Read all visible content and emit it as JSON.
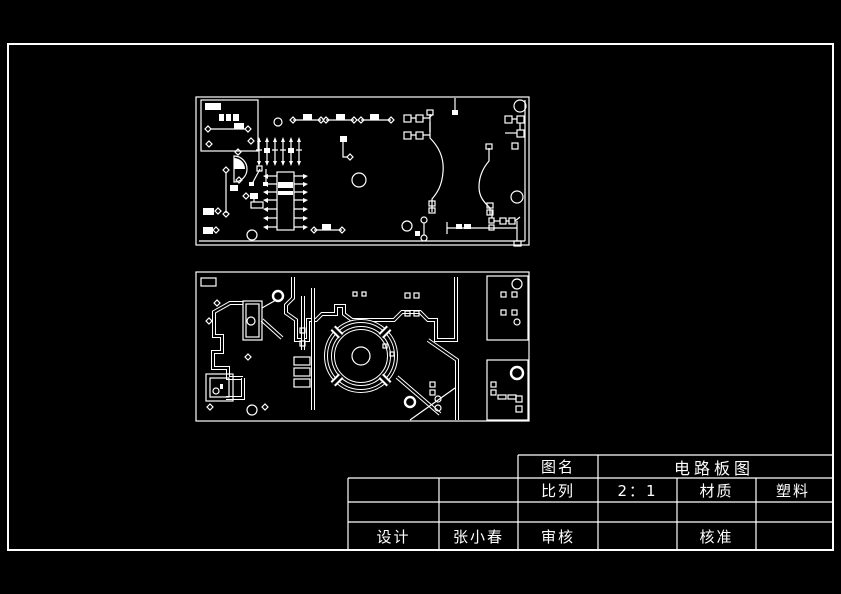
{
  "colors": {
    "background": "#000000",
    "line": "#ffffff"
  },
  "title_block": {
    "drawing_name_label": "图名",
    "drawing_name_value": "电路板图",
    "scale_label": "比列",
    "scale_value": "2：1",
    "material_label": "材质",
    "material_value": "塑料",
    "design_label": "设计",
    "design_value": "张小春",
    "review_label": "审核",
    "review_value": "",
    "approve_label": "核准",
    "approve_value": ""
  }
}
